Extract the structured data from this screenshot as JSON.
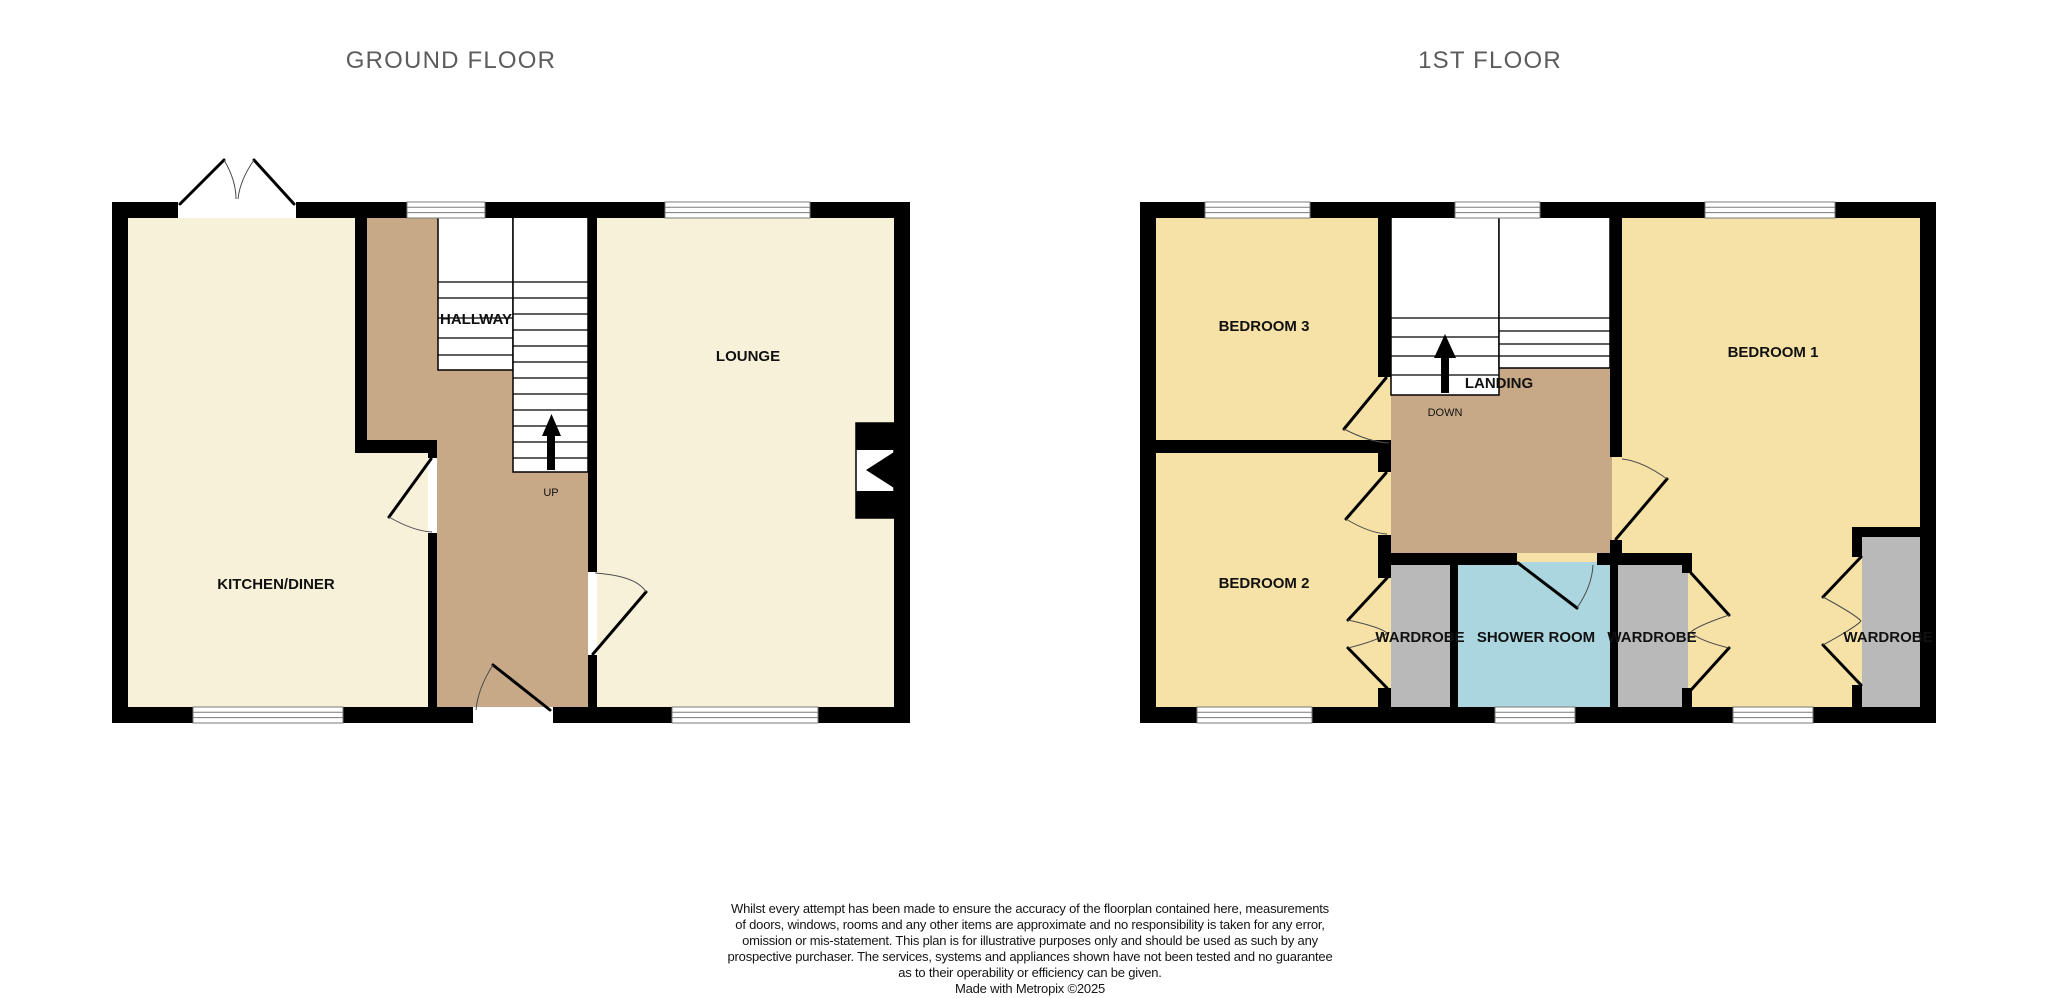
{
  "titles": {
    "ground": "GROUND FLOOR",
    "first": "1ST FLOOR"
  },
  "ground_floor": {
    "kitchen_label": "KITCHEN/DINER",
    "hallway_label": "HALLWAY",
    "lounge_label": "LOUNGE",
    "stairs_direction": "UP"
  },
  "first_floor": {
    "bedroom3_label": "BEDROOM 3",
    "bedroom2_label": "BEDROOM 2",
    "bedroom1_label": "BEDROOM 1",
    "landing_label": "LANDING",
    "stairs_direction": "DOWN",
    "shower_label": "SHOWER ROOM",
    "wardrobe_bedroom2_label": "WARDROBE",
    "wardrobe_bedroom1_inner_label": "WARDROBE",
    "wardrobe_bedroom1_right_label": "WARDROBE"
  },
  "colors": {
    "ground_room_fill": "#f7f1da",
    "hallway_fill": "#c8a987",
    "bedroom_fill": "#f6e2a7",
    "wardrobe_fill": "#b9b9b9",
    "shower_fill": "#abd6e0",
    "wall": "#000000",
    "title_text": "#5b5c5e"
  },
  "disclaimer": {
    "lines": [
      "Whilst every attempt has been made to ensure the accuracy of the floorplan contained here, measurements",
      "of doors, windows, rooms and any other items are approximate and no responsibility is taken for any error,",
      "omission or mis-statement. This plan is for illustrative purposes only and should be used as such by any",
      "prospective purchaser. The services, systems and appliances shown have not been tested and no guarantee",
      "as to their operability or efficiency can be given.",
      "Made with Metropix ©2025"
    ]
  }
}
